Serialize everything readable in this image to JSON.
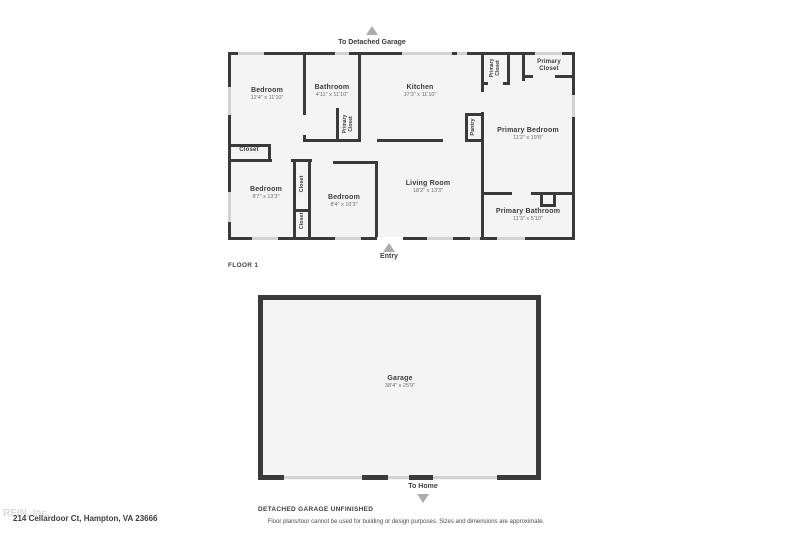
{
  "colors": {
    "wall": "#3a3a3a",
    "floor_fill": "#f4f4f4",
    "window": "#d2d2d2",
    "arrow": "#acacac",
    "label_text": "#3c3c3c",
    "dims_text": "#6e6e6e"
  },
  "floor1": {
    "floor_label": "FLOOR 1",
    "to_garage_label": "To Detached Garage",
    "entry_label": "Entry",
    "rooms": {
      "bedroom1": {
        "name": "Bedroom",
        "dims": "12'4\" x 11'10\""
      },
      "bathroom": {
        "name": "Bathroom",
        "dims": "4'11\" x 11'10\""
      },
      "kitchen": {
        "name": "Kitchen",
        "dims": "17'3\" x 11'10\""
      },
      "primary_closet_a": {
        "name": "Primary Closet"
      },
      "primary_closet_b": {
        "name": "Primary Closet"
      },
      "primary_closet_c": {
        "name": "Primary Closet"
      },
      "pantry": {
        "name": "Pantry"
      },
      "primary_bedroom": {
        "name": "Primary Bedroom",
        "dims": "11'2\" x 19'8\""
      },
      "living_room": {
        "name": "Living Room",
        "dims": "18'2\" x 13'3\""
      },
      "bedroom2": {
        "name": "Bedroom",
        "dims": "8'7\" x 13'3\""
      },
      "bedroom3": {
        "name": "Bedroom",
        "dims": "8'4\" x 10'3\""
      },
      "closet1": {
        "name": "Closet"
      },
      "closet2": {
        "name": "Closet"
      },
      "closet3": {
        "name": "Closet"
      },
      "primary_bathroom": {
        "name": "Primary Bathroom",
        "dims": "11'3\" x 5'10\""
      }
    }
  },
  "garage": {
    "name": "Garage",
    "dims": "38'4\" x 25'9\"",
    "caption": "DETACHED GARAGE UNFINISHED",
    "to_home_label": "To Home"
  },
  "footer": {
    "watermark": "REIN, Inc.",
    "address": "214 Cellardoor Ct, Hampton, VA 23666",
    "disclaimer": "Floor plans/tour cannot be used for building or design purposes. Sizes and dimensions are approximate."
  }
}
